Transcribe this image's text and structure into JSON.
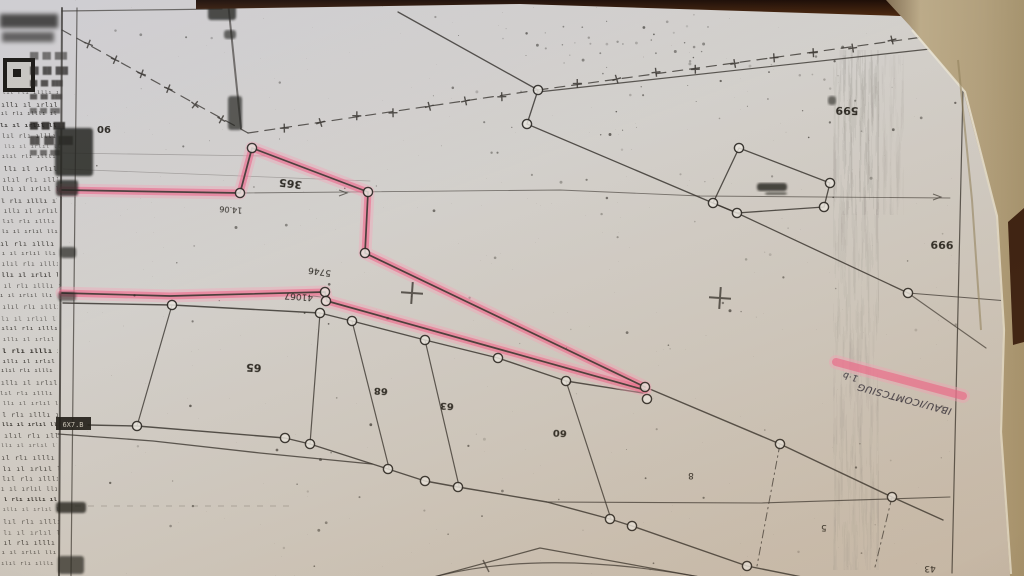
{
  "photo": {
    "highlight_color": "#ee6087",
    "highlight_halo": "#f5a6ba",
    "paper_color": "#d3d0cc",
    "ink_color": "#3a3631",
    "wood_color": "#3e2314",
    "folded_page_color": "#b7a684"
  },
  "map_labels": {
    "ref_06": "06",
    "parcel_365": "365",
    "point_14_06": "14.06",
    "point_5746": "5746",
    "point_41067": "41067",
    "parcel_65": "65",
    "parcel_68": "68",
    "parcel_63": "63",
    "parcel_60": "60",
    "parcel_8": "8",
    "point_5": "5",
    "ref_599": "599",
    "ref_999": "999",
    "ref_43": "43",
    "stamp_box": "6X7.B",
    "handwriting_prefix": "1·b",
    "handwriting_note": "IBAU/ICOMTCSIUG"
  },
  "margin": {
    "row_glyphs_a": "ılıl rlı ılllı ıl mılı ıll",
    "row_glyphs_b": "ıllı ıl ırlıl llı ıır lı",
    "block_glyphs": "██ ██ ███"
  }
}
